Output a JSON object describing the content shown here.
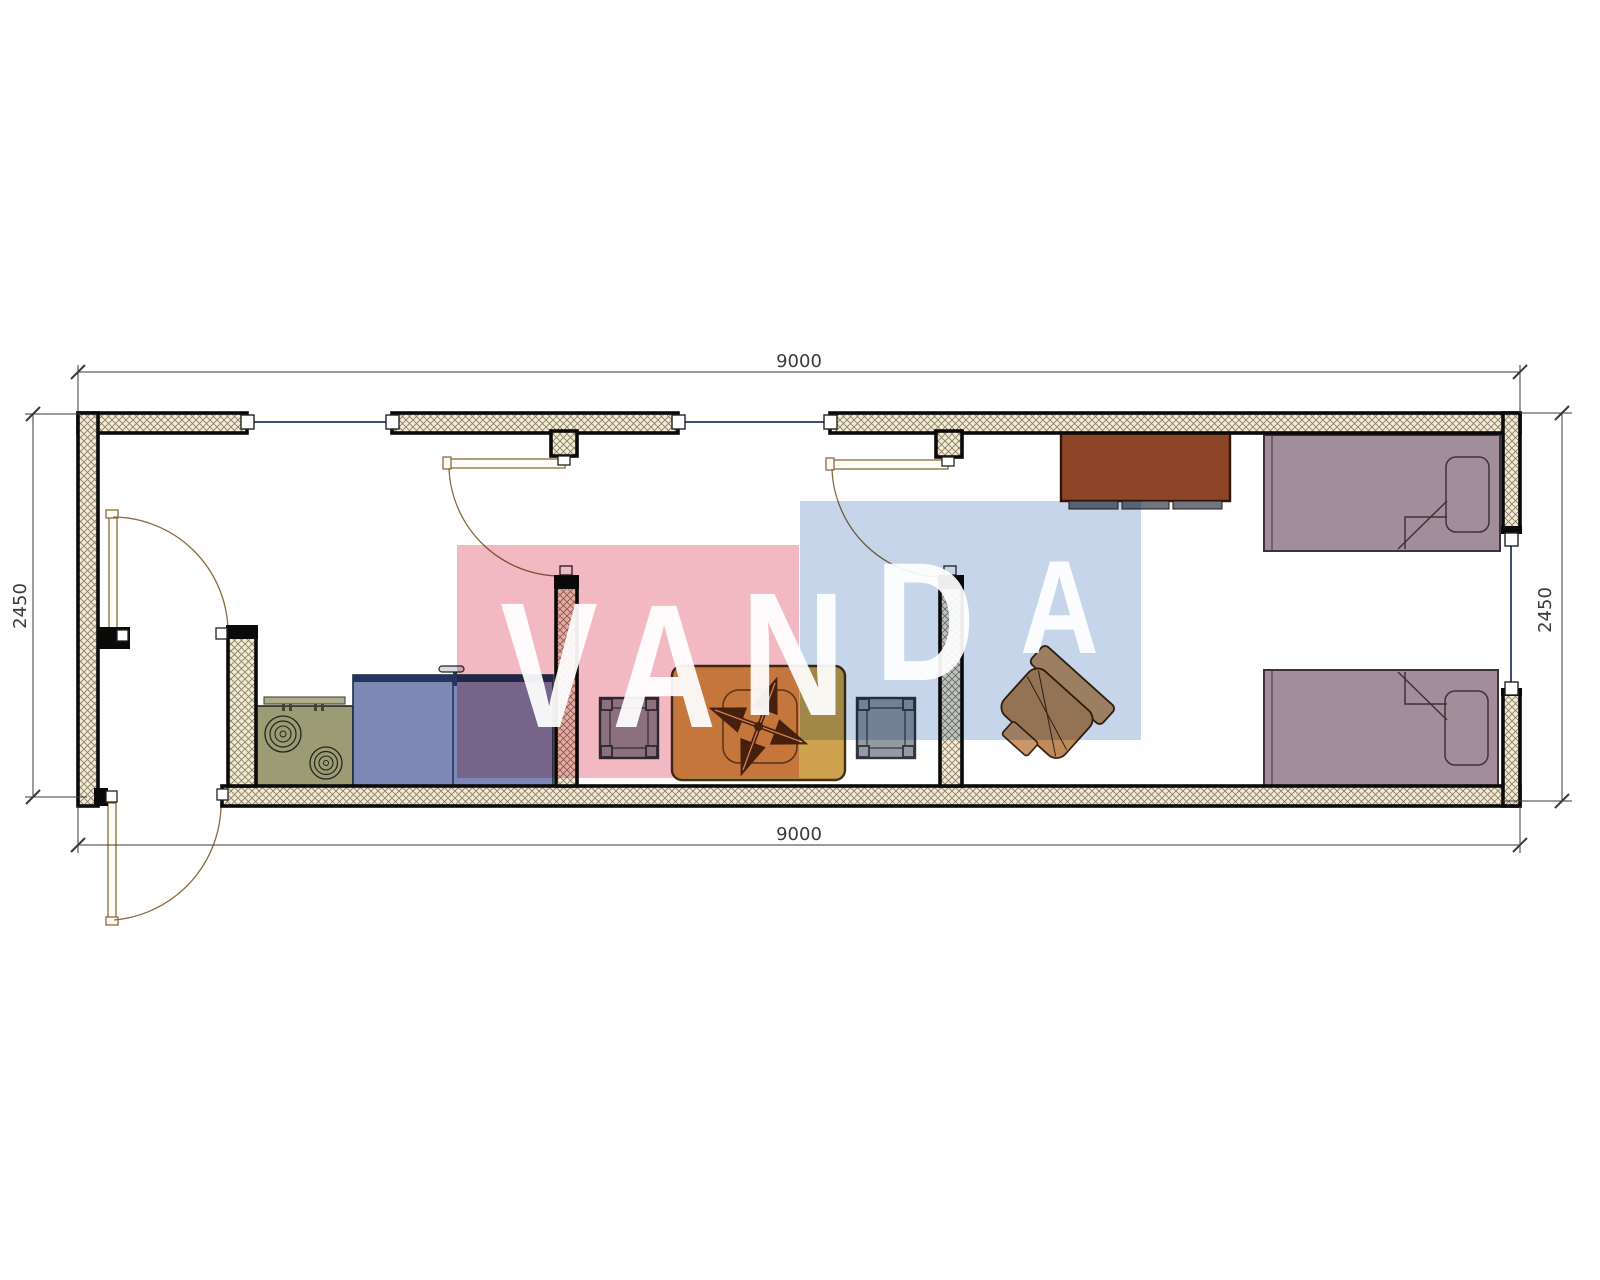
{
  "drawing": {
    "kind": "container-house floor plan",
    "plan_width_mm": "9000",
    "plan_depth_mm": "2450"
  },
  "dimensions": {
    "top": "9000",
    "bottom": "9000",
    "left": "2450",
    "right": "2450"
  },
  "watermark": {
    "letters": [
      "V",
      "A",
      "N",
      "D",
      "A"
    ],
    "pink_color": "#f3b9c3",
    "blue_color": "#c6d5e9",
    "letter_color": "#ffffff"
  },
  "colors": {
    "wall_hatch_bg": "#f1ebd8",
    "wall_hatch_line": "#8d7d60",
    "wall_outline": "#0a0a0a",
    "door_line": "#8a6a3e",
    "window_line": "#3d4a7a",
    "stove": "#9c9c74",
    "counter": "#7d89b4",
    "counter_band": "#23355c",
    "stool": "#949aa4",
    "table": "#cfa24f",
    "table_cross": "#4a2a10",
    "wardrobe": "#8c4527",
    "bed": "#a28e9a",
    "chair": "#c9976b",
    "dimension_text": "#3a3a3a"
  },
  "symbols": [
    {
      "name": "stove-symbol",
      "label": "2-burner cooktop"
    },
    {
      "name": "sink-counter-symbol",
      "label": "kitchen counter with faucet"
    },
    {
      "name": "stool-symbol-left",
      "label": "square stool"
    },
    {
      "name": "dining-table-symbol",
      "label": "table with ceiling fan cross"
    },
    {
      "name": "stool-symbol-right",
      "label": "square stool"
    },
    {
      "name": "desk-chair-symbol",
      "label": "chair"
    },
    {
      "name": "wardrobe-symbol",
      "label": "wardrobe cabinet"
    },
    {
      "name": "bed-symbol-top",
      "label": "single bed with pillow"
    },
    {
      "name": "bed-symbol-bottom",
      "label": "single bed with pillow"
    },
    {
      "name": "door-symbol",
      "label": "swing door"
    },
    {
      "name": "window-symbol",
      "label": "window"
    }
  ]
}
